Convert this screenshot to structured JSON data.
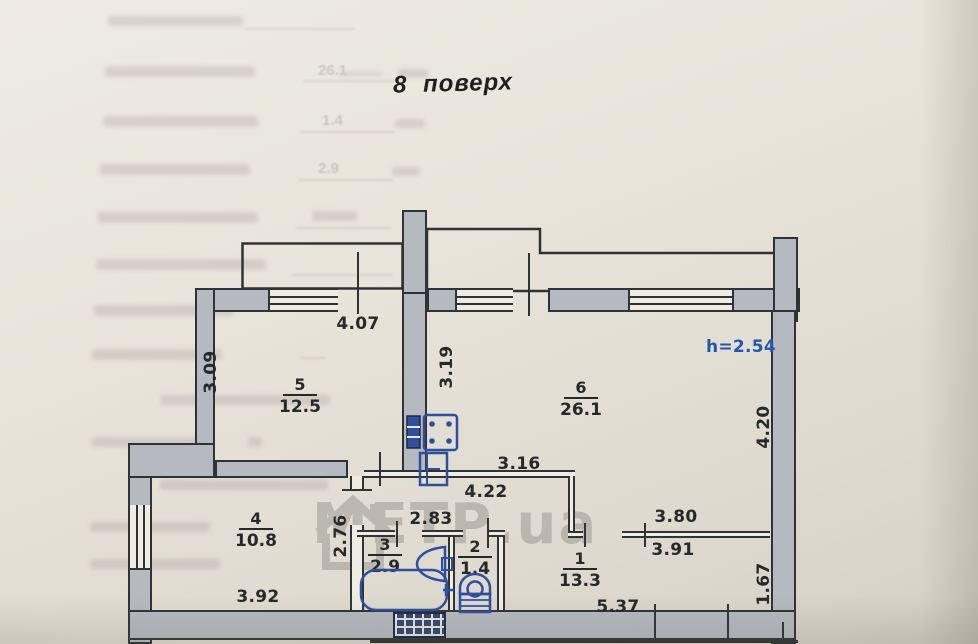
{
  "title": "8  поверх",
  "bleed_form": {
    "values": [
      "26.1",
      "1.4",
      "2.9"
    ]
  },
  "watermark": {
    "text": "МЕТР.ua"
  },
  "plan": {
    "height_note": "h=2.54",
    "rooms": [
      {
        "number": "5",
        "area": "12.5"
      },
      {
        "number": "6",
        "area": "26.1"
      },
      {
        "number": "4",
        "area": "10.8"
      },
      {
        "number": "3",
        "area": "2.9"
      },
      {
        "number": "2",
        "area": "1.4"
      },
      {
        "number": "1",
        "area": "13.3"
      }
    ],
    "dimensions": [
      {
        "text": "4.07"
      },
      {
        "text": "3.09"
      },
      {
        "text": "3.19"
      },
      {
        "text": "4.20"
      },
      {
        "text": "3.16"
      },
      {
        "text": "4.22"
      },
      {
        "text": "2.83"
      },
      {
        "text": "2.76"
      },
      {
        "text": "3.80"
      },
      {
        "text": "3.91"
      },
      {
        "text": "3.92"
      },
      {
        "text": "5.37"
      },
      {
        "text": "1.67"
      }
    ],
    "colors": {
      "annotation_blue": "#2456ad",
      "wall_gray": "#b6bac0",
      "line_dark": "#303335"
    },
    "fixtures": [
      "electric-panel",
      "stove",
      "kitchen-sink",
      "wash-basin",
      "bathtub",
      "toilet",
      "vent-shaft"
    ]
  }
}
